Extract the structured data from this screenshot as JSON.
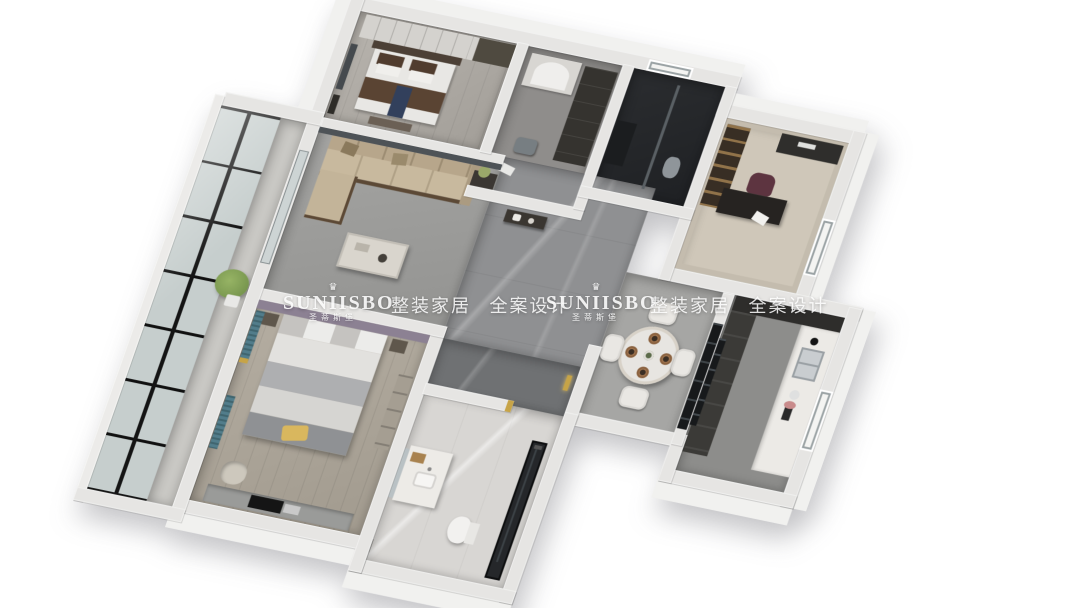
{
  "scene": {
    "description": "3D isometric rendering of an apartment floor plan",
    "rooms": [
      "secondary-bedroom",
      "dressing-room",
      "dark-bathroom",
      "study",
      "living-room",
      "hallway",
      "dining-area",
      "kitchen",
      "master-bedroom",
      "master-bathroom",
      "balcony"
    ]
  },
  "watermark": {
    "icon_glyph": "♛",
    "brand": "SUNIISBO",
    "brand_cn": "圣蒂斯堡",
    "tagline": "整装家居 全案设计",
    "color": "#ffffff",
    "instances": 2
  },
  "palette": {
    "wall_top": "#e6e5e3",
    "teal_curtain": "#4a7280",
    "yellow_pillow": "#d9b75e",
    "lilac_headboard": "#8c8193",
    "gold_accent": "#c7a447",
    "sofa_beige": "#c8b99e",
    "dark_marble": "#6f7173",
    "glazing_frame": "#161616"
  }
}
